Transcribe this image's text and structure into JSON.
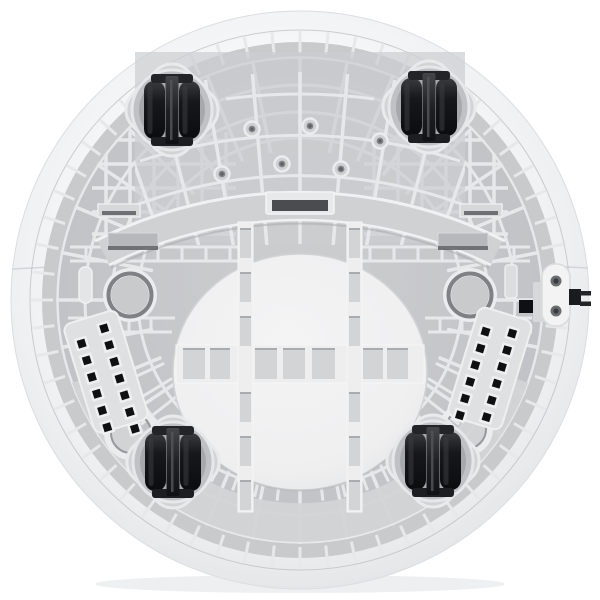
{
  "scene": {
    "type": "product-photo",
    "description": "Bottom view of a round white appliance base: grey ribbed plastic chassis inside a white rim, four black dual caster wheels, central white dome with cross-shaped ribbed bands, arched brace, two round bosses, two slotted vent grilles and a folded power-cord plug on the right edge",
    "background_color": "#ffffff"
  },
  "palette": {
    "bg": "#ffffff",
    "rim_light": "#fcfcfd",
    "rim_mid": "#f2f3f4",
    "rim_edge": "#e0e1e4",
    "ring": "#c9cacc",
    "chassis": "#c6c7c9",
    "upperfan_bg": "#cccdd0",
    "rib": "#e7e8ea",
    "rib_shadow": "#a6a7aa",
    "band_light": "#d3d4d6",
    "arch": "#d0d1d3",
    "dome": "#f0f0f1",
    "dome_band": "#eeeeef",
    "cutout": "#d3d4d6",
    "boss_ring": "#ebeced",
    "boss_groove": "#808184",
    "boss_center": "#c9cacc",
    "vent_panel": "#dfe0e2",
    "vent_hole": "#0f1012",
    "vent_bevel": "#f0f0f2",
    "wheel_dark": "#0c0d0f",
    "wheel_mid": "#17181b",
    "wheel_hi": "#353639",
    "pocket": "#a7a8ab",
    "mount": "#d2d3d5",
    "plate": "#f3f3f4",
    "plug_black": "#1a1b1e",
    "screw": "#6b6c70",
    "tab_bar": "#b7b8bb",
    "tab_shadow": "#5f6063",
    "shadow": "#e3e4e6"
  },
  "components": {
    "caster_wheels": {
      "count": 4,
      "style": "dual-wheel caster with center bracket",
      "color": "#17181b"
    },
    "screw_holes_upper": {
      "count": 6
    },
    "round_bosses_mid": {
      "count": 2
    },
    "open_rings_lower": {
      "count": 2
    },
    "vent_grille_left": {
      "hole_count": 13,
      "columns": 2
    },
    "vent_grille_right": {
      "hole_count": 12,
      "columns": 2
    },
    "power_connector": {
      "screw_holes": 2,
      "plug_prongs": 2,
      "plug_color": "#1a1b1e"
    },
    "arched_brace_clips": {
      "count": 3,
      "center_notch": true
    },
    "rim_seams": {
      "count": 2
    }
  }
}
